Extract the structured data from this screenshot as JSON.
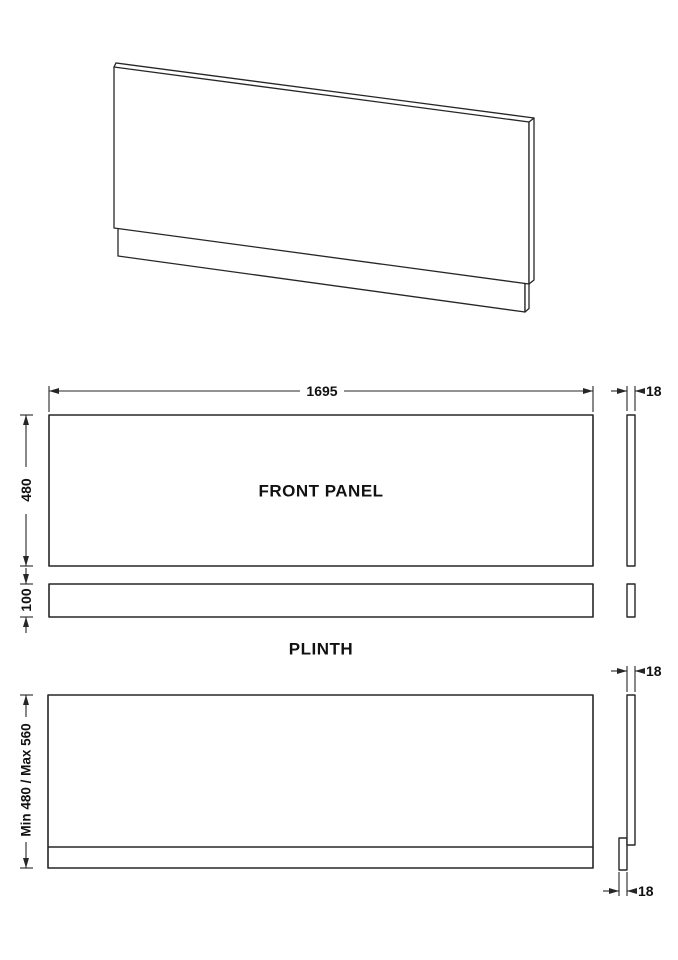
{
  "colors": {
    "line": "#262626",
    "text": "#111111",
    "background": "#ffffff"
  },
  "views": {
    "front_panel": {
      "label": "FRONT PANEL",
      "width": "1695",
      "height": "480",
      "thickness": "18"
    },
    "plinth": {
      "label": "PLINTH",
      "height": "100"
    },
    "assembled": {
      "height_range": "Min 480 / Max 560",
      "panel_thickness": "18",
      "plinth_thickness": "18"
    }
  }
}
